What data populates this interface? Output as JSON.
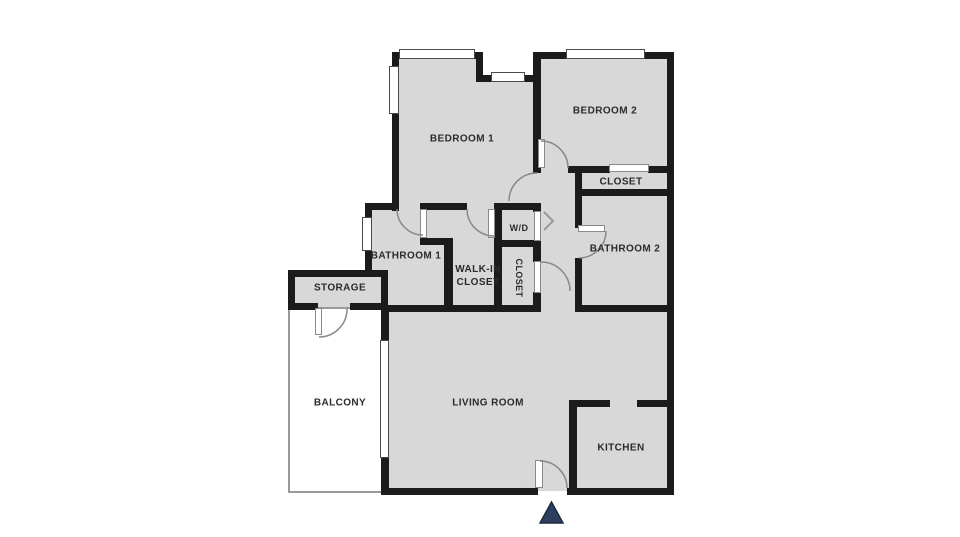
{
  "colors": {
    "floor": "#d8d8d8",
    "wall": "#1b1b1b",
    "arrow": "#2d3e5f"
  },
  "rooms": {
    "bedroom1": "BEDROOM 1",
    "bedroom2": "BEDROOM 2",
    "closet_upper": "CLOSET",
    "bathroom2": "BATHROOM 2",
    "wd": "W/D",
    "bathroom1": "BATHROOM 1",
    "walkin_line1": "WALK-IN",
    "walkin_line2": "CLOSET",
    "closet_hall": "CLOSET",
    "storage": "STORAGE",
    "balcony": "BALCONY",
    "living_room": "LIVING ROOM",
    "kitchen": "KITCHEN"
  }
}
